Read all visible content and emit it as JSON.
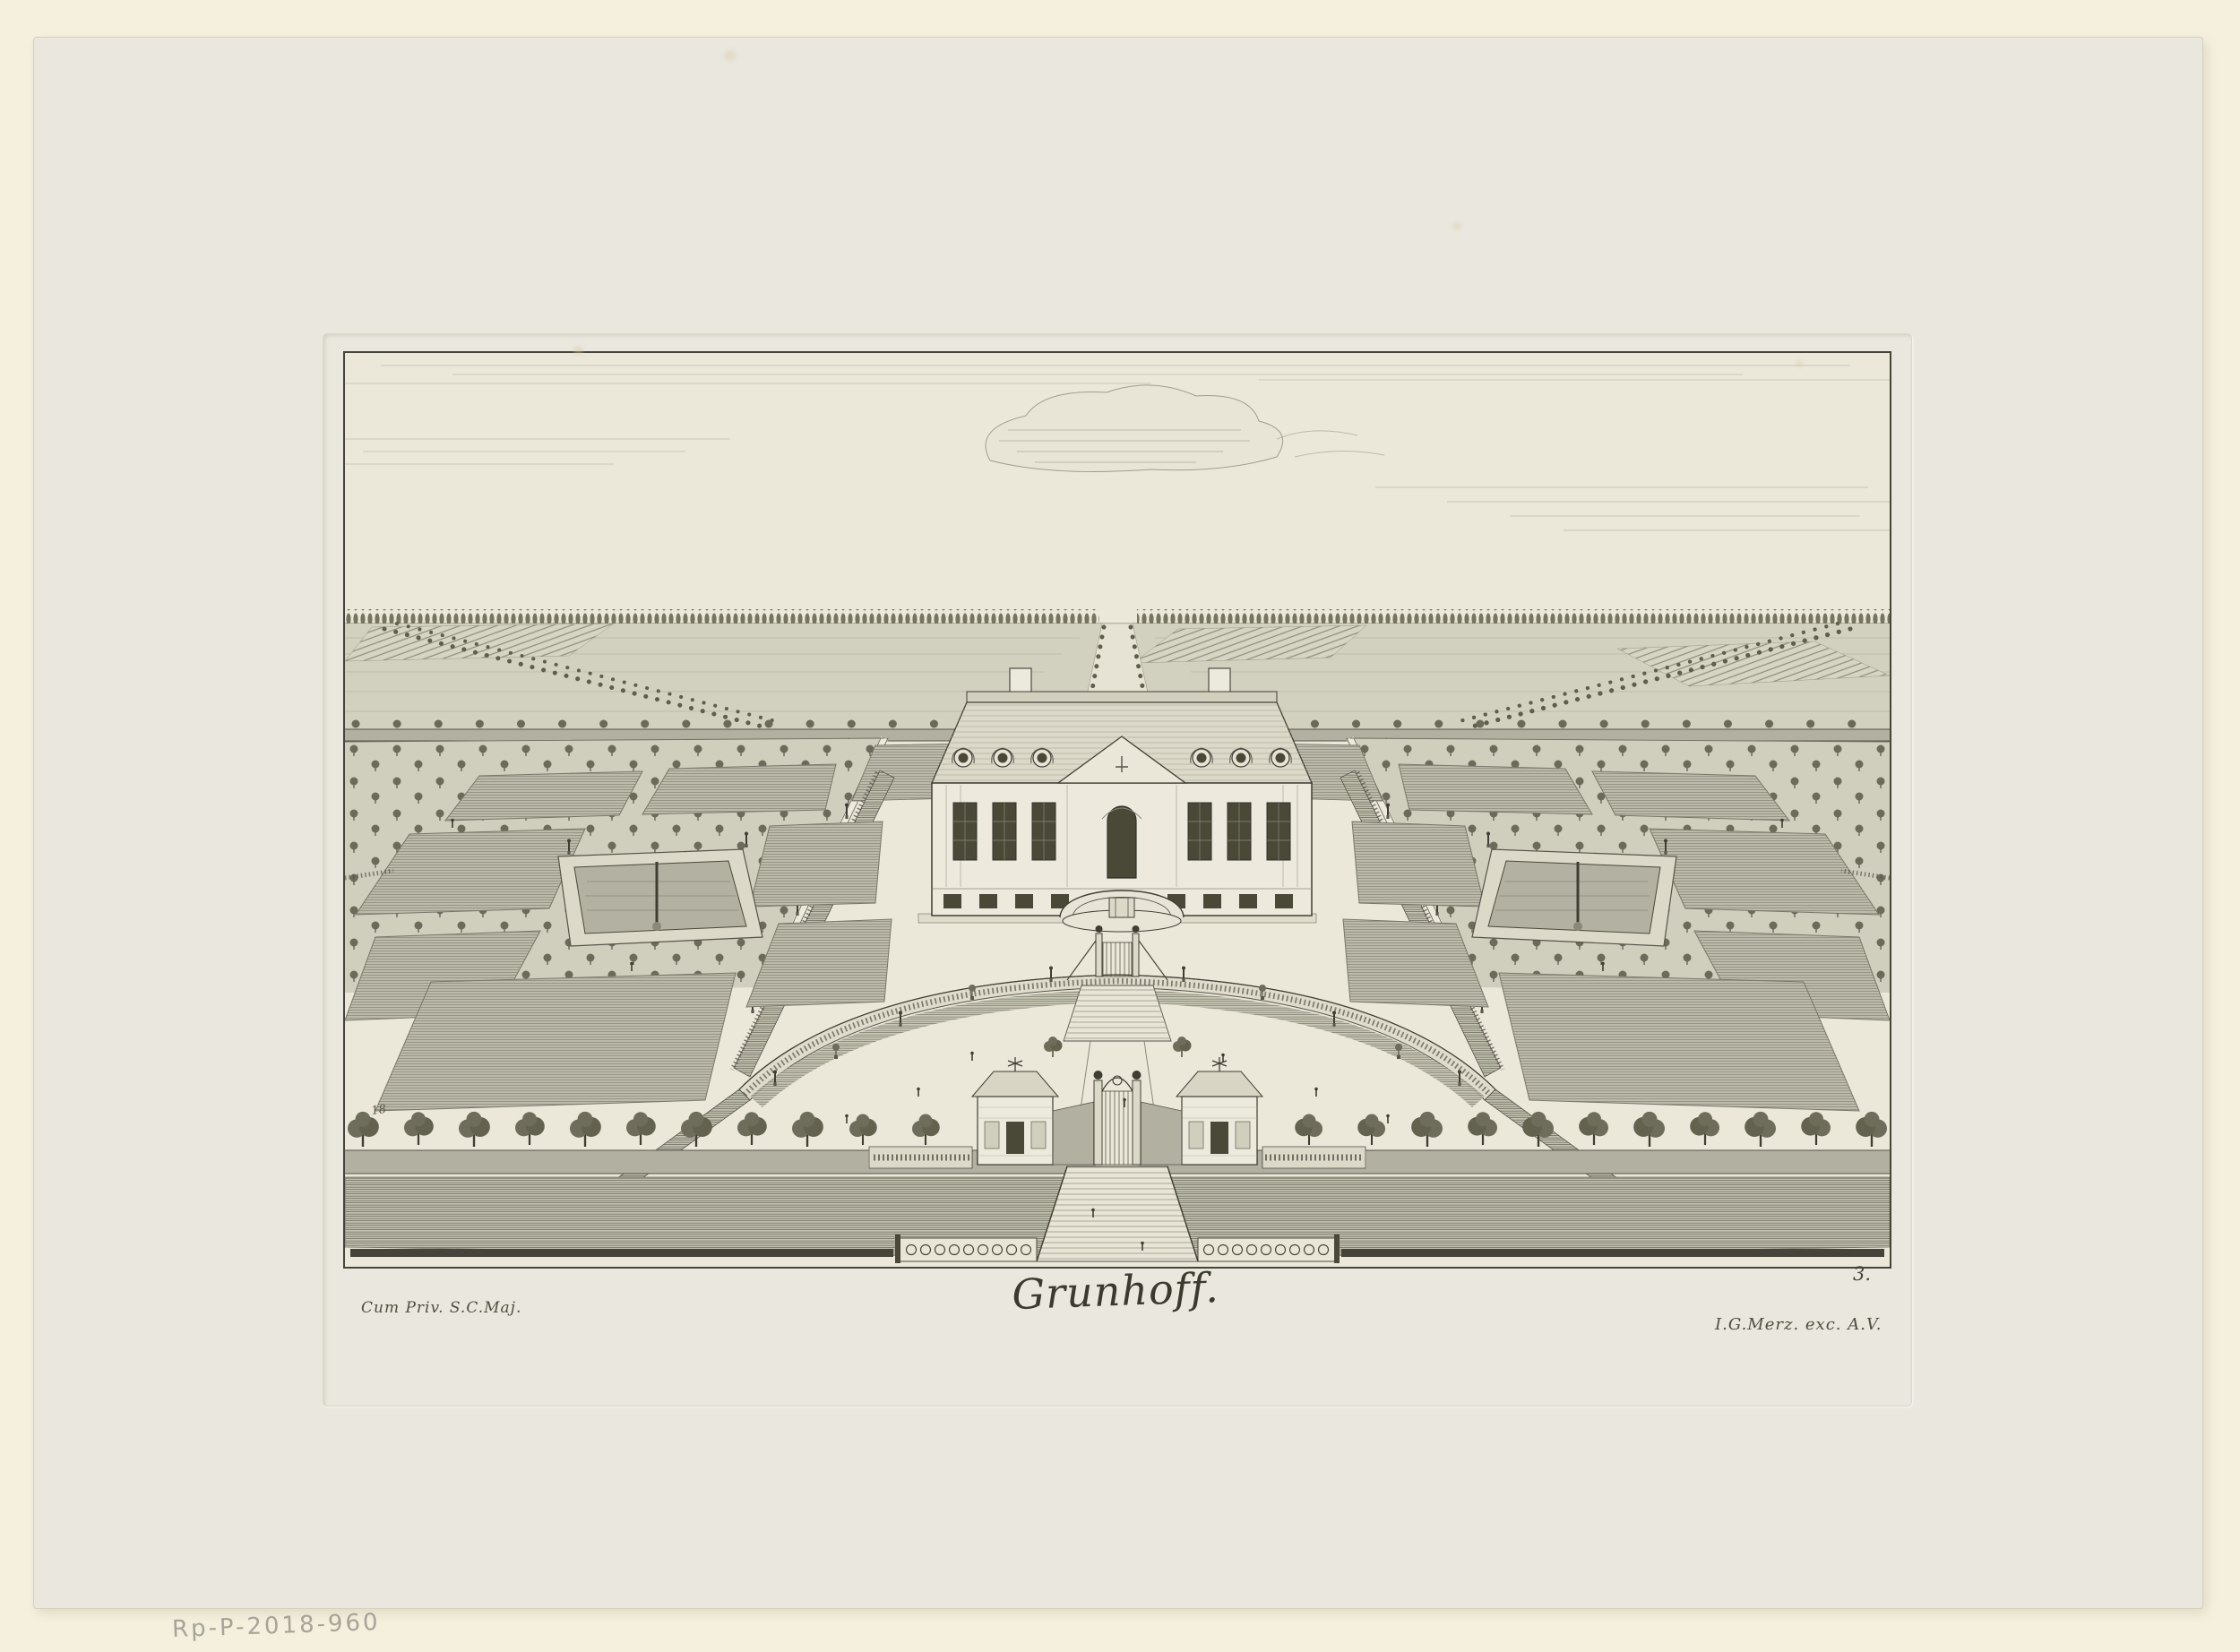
{
  "artwork": {
    "title": "Grunhoff.",
    "privilege_inscription": "Cum Priv. S.C.Maj.",
    "publisher_inscription": "I.G.Merz. exc. A.V.",
    "plate_number": "3.",
    "corner_mark": "18",
    "accession_number": "Rp-P-2018-960"
  },
  "colors": {
    "mount": "#f4f0dd",
    "sheet": "#e9e7de",
    "plate_tint": "#ebe8da",
    "ink": "#3c3b30",
    "lawn_tone": "#bcbbab",
    "field_tone": "#d2d0bf",
    "pencil": "#a3a096"
  }
}
